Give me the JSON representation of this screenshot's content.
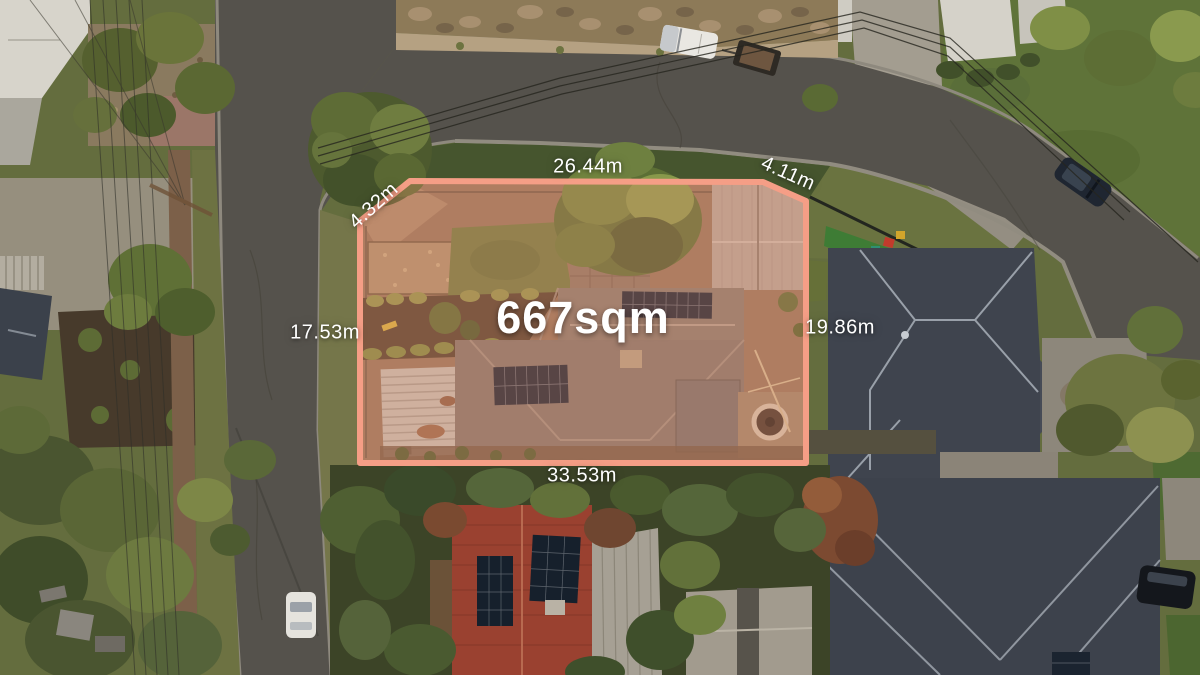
{
  "property_overlay": {
    "area_label": "667sqm",
    "boundary_color": "#f59e86",
    "boundary_fill": "rgba(244,148,115,0.28)",
    "label_color": "#ffffff",
    "measurements": {
      "top": "26.44m",
      "top_left": "4.32m",
      "top_right": "4.11m",
      "left": "17.53m",
      "right": "19.86m",
      "bottom": "33.53m"
    }
  }
}
